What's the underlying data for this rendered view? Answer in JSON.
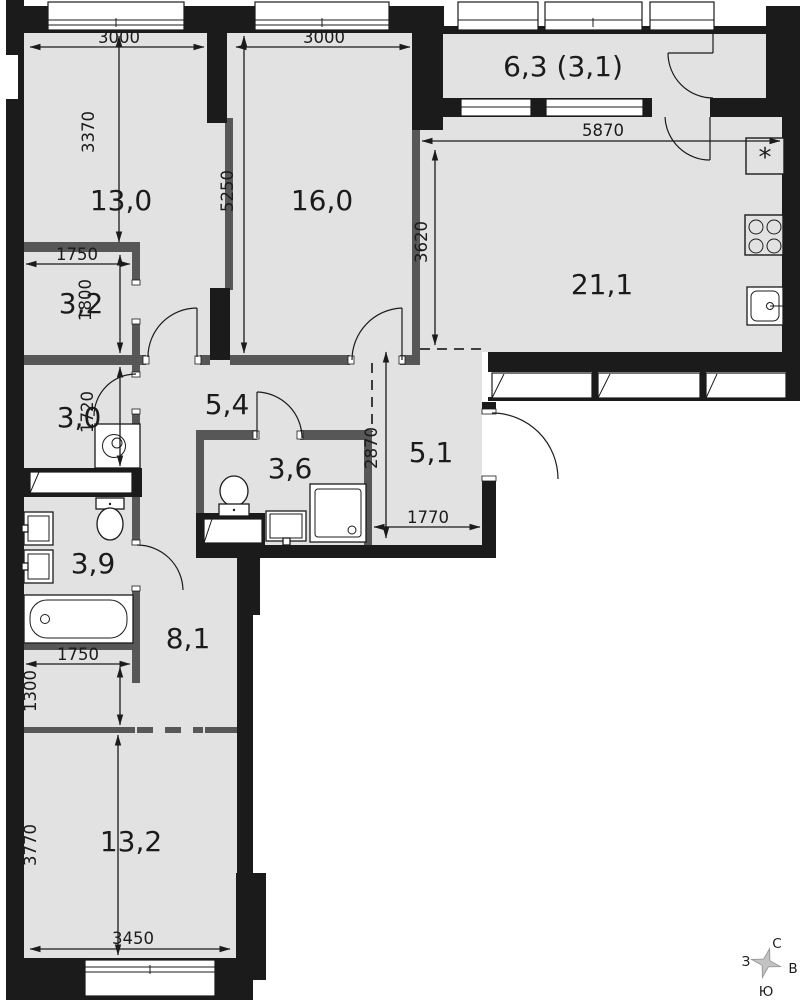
{
  "rooms": [
    {
      "key": "room-13-0",
      "area": "13,0"
    },
    {
      "key": "room-16-0",
      "area": "16,0"
    },
    {
      "key": "balcony",
      "area": "6,3 (3,1)"
    },
    {
      "key": "kitchen",
      "area": "21,1"
    },
    {
      "key": "room-3-2",
      "area": "3,2"
    },
    {
      "key": "room-3-0",
      "area": "3,0"
    },
    {
      "key": "corridor",
      "area": "5,4"
    },
    {
      "key": "bathroom",
      "area": "3,6"
    },
    {
      "key": "entry",
      "area": "5,1"
    },
    {
      "key": "bathroom-2",
      "area": "3,9"
    },
    {
      "key": "hallway",
      "area": "8,1"
    },
    {
      "key": "room-13-2",
      "area": "13,2"
    }
  ],
  "dimensions": [
    {
      "key": "dim-3000-left",
      "value": "3000"
    },
    {
      "key": "dim-3000-right",
      "value": "3000"
    },
    {
      "key": "dim-3370",
      "value": "3370"
    },
    {
      "key": "dim-5250",
      "value": "5250"
    },
    {
      "key": "dim-5870",
      "value": "5870"
    },
    {
      "key": "dim-3620",
      "value": "3620"
    },
    {
      "key": "dim-1750-top",
      "value": "1750"
    },
    {
      "key": "dim-1800",
      "value": "1800"
    },
    {
      "key": "dim-1720",
      "value": "1720"
    },
    {
      "key": "dim-2870",
      "value": "2870"
    },
    {
      "key": "dim-1770",
      "value": "1770"
    },
    {
      "key": "dim-1750-bottom",
      "value": "1750"
    },
    {
      "key": "dim-1300",
      "value": "1300"
    },
    {
      "key": "dim-3770",
      "value": "3770"
    },
    {
      "key": "dim-3450",
      "value": "3450"
    }
  ],
  "compass": {
    "north": "С",
    "south": "Ю",
    "west": "З",
    "east": "В"
  },
  "symbols": {
    "fridge": "*"
  },
  "colors": {
    "wall": "#1b1b1b",
    "partition": "#575757",
    "floor": "#e2e2e2"
  }
}
